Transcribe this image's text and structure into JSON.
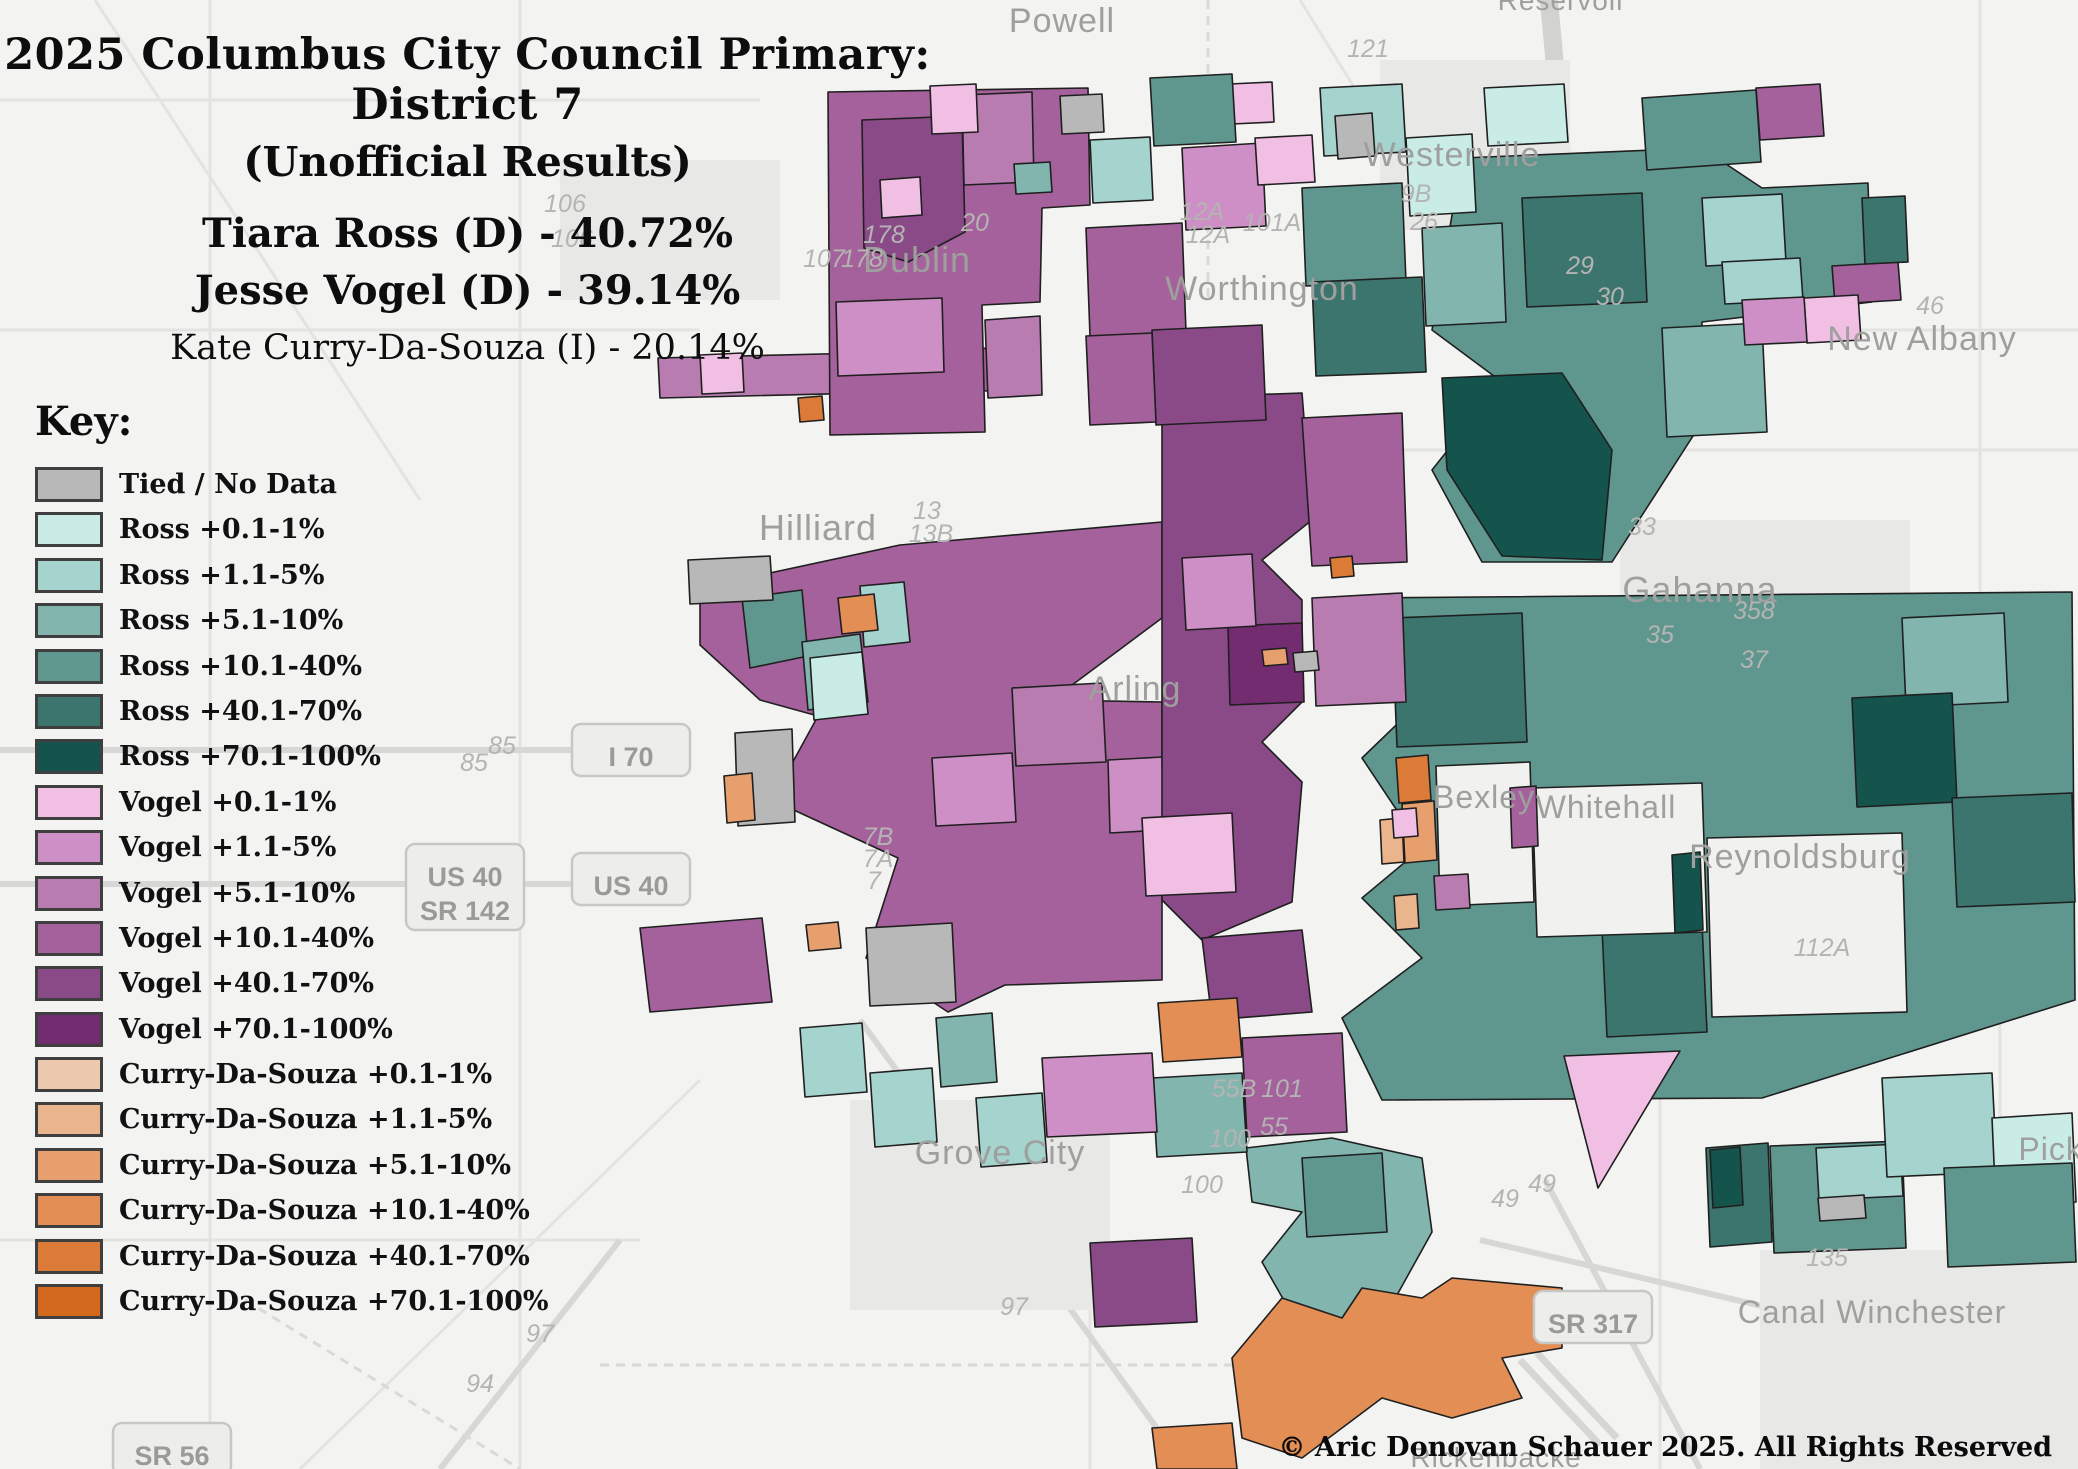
{
  "title": {
    "line1": "2025 Columbus City Council Primary: District 7",
    "line2": "(Unofficial Results)"
  },
  "results": [
    {
      "text": "Tiara Ross (D) - 40.72%",
      "emphasis": "bold"
    },
    {
      "text": "Jesse Vogel (D) - 39.14%",
      "emphasis": "bold"
    },
    {
      "text": "Kate Curry-Da-Souza (I) - 20.14%",
      "emphasis": "normal"
    }
  ],
  "key_header": "Key:",
  "copyright": "© Aric Donovan Schauer 2025. All Rights Reserved",
  "legend": {
    "items": [
      {
        "id": "tied",
        "label": "Tied / No Data",
        "color": "#b8b8b8"
      },
      {
        "id": "ross1",
        "label": "Ross +0.1-1%",
        "color": "#c9ece7"
      },
      {
        "id": "ross2",
        "label": "Ross +1.1-5%",
        "color": "#a5d3cd"
      },
      {
        "id": "ross3",
        "label": "Ross +5.1-10%",
        "color": "#81b5ae"
      },
      {
        "id": "ross4",
        "label": "Ross +10.1-40%",
        "color": "#5f978f"
      },
      {
        "id": "ross5",
        "label": "Ross +40.1-70%",
        "color": "#3c746e"
      },
      {
        "id": "ross6",
        "label": "Ross +70.1-100%",
        "color": "#15544c"
      },
      {
        "id": "vogel1",
        "label": "Vogel +0.1-1%",
        "color": "#f0bfe3"
      },
      {
        "id": "vogel2",
        "label": "Vogel +1.1-5%",
        "color": "#cd8fc5"
      },
      {
        "id": "vogel3",
        "label": "Vogel +5.1-10%",
        "color": "#b97cb1"
      },
      {
        "id": "vogel4",
        "label": "Vogel +10.1-40%",
        "color": "#a4619c"
      },
      {
        "id": "vogel5",
        "label": "Vogel +40.1-70%",
        "color": "#8a4a87"
      },
      {
        "id": "vogel6",
        "label": "Vogel +70.1-100%",
        "color": "#722c6f"
      },
      {
        "id": "curry1",
        "label": "Curry-Da-Souza +0.1-1%",
        "color": "#ecc8ac"
      },
      {
        "id": "curry2",
        "label": "Curry-Da-Souza +1.1-5%",
        "color": "#eab48c"
      },
      {
        "id": "curry3",
        "label": "Curry-Da-Souza +5.1-10%",
        "color": "#e7a06d"
      },
      {
        "id": "curry4",
        "label": "Curry-Da-Souza +10.1-40%",
        "color": "#e28e55"
      },
      {
        "id": "curry5",
        "label": "Curry-Da-Souza +40.1-70%",
        "color": "#dc7a38"
      },
      {
        "id": "curry6",
        "label": "Curry-Da-Souza +70.1-100%",
        "color": "#d2691d"
      }
    ]
  },
  "map": {
    "enclave_color": "#f1f1ef",
    "city_labels": [
      {
        "text": "Powell",
        "x": 1062,
        "y": 32,
        "size": 34
      },
      {
        "text": "Reservoir",
        "x": 1562,
        "y": 10,
        "size": 28
      },
      {
        "text": "Westerville",
        "x": 1452,
        "y": 166,
        "size": 34
      },
      {
        "text": "Dublin",
        "x": 917,
        "y": 272,
        "size": 36
      },
      {
        "text": "Worthington",
        "x": 1262,
        "y": 300,
        "size": 34
      },
      {
        "text": "New Albany",
        "x": 1922,
        "y": 350,
        "size": 34
      },
      {
        "text": "Hilliard",
        "x": 818,
        "y": 540,
        "size": 36
      },
      {
        "text": "Gahanna",
        "x": 1700,
        "y": 602,
        "size": 36
      },
      {
        "text": "Arling",
        "x": 1135,
        "y": 700,
        "size": 34
      },
      {
        "text": "Bexley",
        "x": 1484,
        "y": 808,
        "size": 32
      },
      {
        "text": "Whitehall",
        "x": 1606,
        "y": 818,
        "size": 32
      },
      {
        "text": "Reynoldsburg",
        "x": 1800,
        "y": 868,
        "size": 34
      },
      {
        "text": "Grove City",
        "x": 1000,
        "y": 1164,
        "size": 34
      },
      {
        "text": "Canal Winchester",
        "x": 1872,
        "y": 1323,
        "size": 32
      },
      {
        "text": "Picke",
        "x": 2060,
        "y": 1160,
        "size": 32
      },
      {
        "text": "Rickenbacke",
        "x": 1496,
        "y": 1467,
        "size": 28
      }
    ],
    "route_labels": [
      {
        "text": "121",
        "x": 1368,
        "y": 57
      },
      {
        "text": "106",
        "x": 565,
        "y": 212
      },
      {
        "text": "106",
        "x": 572,
        "y": 247
      },
      {
        "text": "178",
        "x": 884,
        "y": 243
      },
      {
        "text": "107",
        "x": 824,
        "y": 267
      },
      {
        "text": "178",
        "x": 862,
        "y": 267
      },
      {
        "text": "20",
        "x": 975,
        "y": 231
      },
      {
        "text": "12A",
        "x": 1202,
        "y": 220
      },
      {
        "text": "12A",
        "x": 1208,
        "y": 243
      },
      {
        "text": "101A",
        "x": 1272,
        "y": 231
      },
      {
        "text": "9B",
        "x": 1416,
        "y": 202
      },
      {
        "text": "26",
        "x": 1424,
        "y": 230
      },
      {
        "text": "29",
        "x": 1580,
        "y": 274
      },
      {
        "text": "30",
        "x": 1610,
        "y": 305
      },
      {
        "text": "46",
        "x": 1930,
        "y": 314
      },
      {
        "text": "33",
        "x": 1642,
        "y": 535
      },
      {
        "text": "358",
        "x": 1754,
        "y": 619
      },
      {
        "text": "35",
        "x": 1660,
        "y": 643
      },
      {
        "text": "37",
        "x": 1754,
        "y": 668
      },
      {
        "text": "13",
        "x": 927,
        "y": 519
      },
      {
        "text": "13B",
        "x": 931,
        "y": 542
      },
      {
        "text": "85",
        "x": 502,
        "y": 754
      },
      {
        "text": "85",
        "x": 474,
        "y": 771
      },
      {
        "text": "7B",
        "x": 878,
        "y": 845
      },
      {
        "text": "7A",
        "x": 878,
        "y": 867
      },
      {
        "text": "7",
        "x": 874,
        "y": 889
      },
      {
        "text": "112A",
        "x": 1822,
        "y": 956
      },
      {
        "text": "55B",
        "x": 1234,
        "y": 1097
      },
      {
        "text": "101",
        "x": 1282,
        "y": 1097
      },
      {
        "text": "55",
        "x": 1274,
        "y": 1135
      },
      {
        "text": "100",
        "x": 1230,
        "y": 1147
      },
      {
        "text": "100",
        "x": 1202,
        "y": 1193
      },
      {
        "text": "49",
        "x": 1542,
        "y": 1192
      },
      {
        "text": "49",
        "x": 1505,
        "y": 1207
      },
      {
        "text": "135",
        "x": 1827,
        "y": 1266
      },
      {
        "text": "97",
        "x": 1014,
        "y": 1315
      },
      {
        "text": "97",
        "x": 540,
        "y": 1342
      },
      {
        "text": "94",
        "x": 480,
        "y": 1392
      }
    ],
    "shields": [
      {
        "lines": [
          "I 70"
        ],
        "x": 631,
        "y": 750
      },
      {
        "lines": [
          "US 40"
        ],
        "x": 631,
        "y": 879
      },
      {
        "lines": [
          "US 40",
          "SR 142"
        ],
        "x": 465,
        "y": 887
      },
      {
        "lines": [
          "SR 317"
        ],
        "x": 1593,
        "y": 1317
      },
      {
        "lines": [
          "SR 56"
        ],
        "x": 172,
        "y": 1449
      }
    ],
    "regions": [
      {
        "c": "vogel3",
        "p": "658,358 905,352 907,392 660,398"
      },
      {
        "c": "ross2",
        "p": "907,352 948,350 950,390 909,392"
      },
      {
        "c": "vogel4",
        "p": "950,350 1012,347 1014,390 952,392"
      },
      {
        "c": "vogel1",
        "p": "700,355 742,353 744,392 702,394"
      },
      {
        "c": "vogel4",
        "p": "828,92 1088,88 1090,205 1042,208 1040,302 982,305 985,432 830,435"
      },
      {
        "c": "vogel5",
        "p": "862,120 962,116 965,232 908,262 864,248"
      },
      {
        "c": "vogel3",
        "p": "962,95 1032,92 1034,182 964,185"
      },
      {
        "c": "vogel2",
        "p": "836,302 942,298 944,372 838,376"
      },
      {
        "c": "vogel1",
        "p": "930,86 976,84 978,132 932,134"
      },
      {
        "c": "ross3",
        "p": "1014,164 1050,162 1052,192 1016,194"
      },
      {
        "c": "tied",
        "p": "1060,96 1102,94 1104,132 1062,134"
      },
      {
        "c": "curry5",
        "p": "798,398 822,396 824,420 800,422"
      },
      {
        "c": "vogel3",
        "p": "985,320 1040,316 1042,395 988,398"
      },
      {
        "c": "vogel1",
        "p": "880,180 920,177 922,215 882,218"
      },
      {
        "c": "vogel4",
        "p": "700,588 900,545 1162,522 1162,618 1052,700 1162,702 1162,980 1005,985 948,1012 866,958 898,858 772,800 818,716 760,700 700,645"
      },
      {
        "c": "ross4",
        "p": "742,598 802,590 808,656 750,668"
      },
      {
        "c": "ross3",
        "p": "802,642 860,634 868,702 808,710"
      },
      {
        "c": "ross2",
        "p": "860,586 904,582 910,642 864,647"
      },
      {
        "c": "ross1",
        "p": "810,658 862,652 868,714 814,720"
      },
      {
        "c": "curry4",
        "p": "838,598 874,594 878,630 842,634"
      },
      {
        "c": "tied",
        "p": "688,560 770,556 773,600 690,604"
      },
      {
        "c": "tied",
        "p": "735,733 792,729 795,822 738,826"
      },
      {
        "c": "vogel3",
        "p": "1012,688 1102,683 1106,762 1016,766"
      },
      {
        "c": "vogel2",
        "p": "932,758 1012,753 1016,822 936,826"
      },
      {
        "c": "tied",
        "p": "866,928 952,923 956,1002 870,1006"
      },
      {
        "c": "vogel4",
        "p": "640,928 762,918 772,1002 650,1012"
      },
      {
        "c": "vogel2",
        "p": "1108,760 1162,757 1164,830 1110,833"
      },
      {
        "c": "curry3",
        "p": "724,776 752,773 755,820 727,823"
      },
      {
        "c": "curry3",
        "p": "806,925 838,922 841,948 809,951"
      },
      {
        "c": "ross4",
        "p": "1462,158 1702,148 1762,188 1868,183 1872,302 1702,322 1702,422 1612,562 1482,562 1432,470 1502,382 1432,330"
      },
      {
        "c": "ross5",
        "p": "1522,198 1642,193 1647,302 1527,307"
      },
      {
        "c": "ross6",
        "p": "1442,378 1562,373 1612,450 1602,560 1502,556 1447,470"
      },
      {
        "c": "ross3",
        "p": "1662,328 1762,323 1767,432 1667,437"
      },
      {
        "c": "ross2",
        "p": "1702,198 1782,194 1786,262 1706,266"
      },
      {
        "c": "vogel4",
        "p": "1756,88 1820,84 1824,136 1760,140"
      },
      {
        "c": "ross4",
        "p": "1642,98 1756,90 1761,162 1647,170"
      },
      {
        "c": "ross2",
        "p": "1722,262 1800,258 1803,300 1725,304"
      },
      {
        "c": "vogel4",
        "p": "1832,266 1898,262 1901,300 1835,304"
      },
      {
        "c": "vogel1",
        "p": "1804,298 1858,295 1861,340 1807,343"
      },
      {
        "c": "vogel2",
        "p": "1742,300 1804,297 1807,342 1745,345"
      },
      {
        "c": "ross5",
        "p": "1862,198 1905,196 1908,262 1865,264"
      },
      {
        "c": "ross1",
        "p": "1484,88 1564,84 1568,142 1488,146"
      },
      {
        "c": "ross4",
        "p": "1362,598 2072,592 2075,1000 1762,1098 1382,1100 1342,1018 1422,958 1362,898 1422,848 1362,758 1422,700"
      },
      {
        "c": "ross5",
        "p": "1392,618 1522,613 1527,742 1397,747"
      },
      {
        "c": "ross3",
        "p": "1902,618 2004,613 2008,702 1906,707"
      },
      {
        "c": "ross6",
        "p": "1852,698 1952,693 1957,802 1857,807"
      },
      {
        "c": "ross5",
        "p": "1602,928 1702,923 1707,1032 1607,1037"
      },
      {
        "c": "ross5",
        "p": "1952,798 2072,793 2075,902 1957,907"
      },
      {
        "c": "nodist",
        "p": "1436,766 1530,762 1534,902 1440,906"
      },
      {
        "c": "nodist",
        "p": "1532,788 1702,783 1707,932 1537,937"
      },
      {
        "c": "nodist",
        "p": "1707,838 1902,833 1907,1012 1712,1017"
      },
      {
        "c": "ross6",
        "p": "1672,855 1700,852 1703,930 1675,933"
      },
      {
        "c": "curry5",
        "p": "1396,758 1428,755 1431,800 1399,803"
      },
      {
        "c": "curry3",
        "p": "1402,804 1434,801 1437,860 1405,863"
      },
      {
        "c": "curry2",
        "p": "1380,820 1402,818 1404,862 1382,864"
      },
      {
        "c": "vogel1",
        "p": "1392,810 1416,808 1418,836 1394,838"
      },
      {
        "c": "vogel4",
        "p": "1510,788 1536,786 1538,846 1512,848"
      },
      {
        "c": "vogel3",
        "p": "1434,876 1468,874 1470,908 1436,910"
      },
      {
        "c": "curry2",
        "p": "1394,896 1417,894 1419,928 1396,930"
      },
      {
        "c": "vogel5",
        "p": "1162,398 1302,393 1312,520 1262,560 1302,600 1302,702 1262,742 1302,782 1292,902 1202,940 1162,900"
      },
      {
        "c": "vogel4",
        "p": "1302,418 1402,413 1407,562 1312,566"
      },
      {
        "c": "vogel6",
        "p": "1228,626 1302,623 1304,702 1230,705"
      },
      {
        "c": "vogel3",
        "p": "1312,598 1402,593 1406,702 1316,706"
      },
      {
        "c": "vogel2",
        "p": "1182,558 1252,554 1256,626 1186,630"
      },
      {
        "c": "vogel1",
        "p": "1142,818 1232,813 1236,892 1146,896"
      },
      {
        "c": "vogel5",
        "p": "1202,938 1302,930 1312,1012 1212,1020"
      },
      {
        "c": "curry3",
        "p": "1262,650 1286,648 1288,664 1264,666"
      },
      {
        "c": "tied",
        "p": "1293,653 1317,651 1319,670 1295,672"
      },
      {
        "c": "curry5",
        "p": "1330,558 1352,556 1354,576 1332,578"
      },
      {
        "c": "vogel4",
        "p": "1086,228 1182,223 1186,332 1090,336"
      },
      {
        "c": "vogel5",
        "p": "1152,330 1262,325 1266,420 1156,425"
      },
      {
        "c": "vogel2",
        "p": "1182,148 1262,143 1266,226 1186,230"
      },
      {
        "c": "vogel1",
        "p": "1255,138 1312,135 1315,182 1258,185"
      },
      {
        "c": "ross2",
        "p": "1320,88 1402,84 1406,152 1324,156"
      },
      {
        "c": "ross1",
        "p": "1406,138 1472,134 1476,212 1410,216"
      },
      {
        "c": "ross4",
        "p": "1302,188 1402,183 1406,282 1306,286"
      },
      {
        "c": "ross5",
        "p": "1312,282 1422,277 1426,372 1316,376"
      },
      {
        "c": "ross3",
        "p": "1422,228 1502,223 1506,322 1426,326"
      },
      {
        "c": "tied",
        "p": "1335,116 1372,113 1375,156 1338,159"
      },
      {
        "c": "vogel4",
        "p": "1086,336 1152,333 1156,422 1090,425"
      },
      {
        "c": "vogel1",
        "p": "1230,84 1272,82 1274,122 1232,124"
      },
      {
        "c": "ross4",
        "p": "1150,78 1232,74 1236,142 1154,146"
      },
      {
        "c": "ross2",
        "p": "1090,140 1150,137 1153,200 1093,203"
      },
      {
        "c": "ross5",
        "p": "1706,1148 1768,1143 1772,1242 1710,1247"
      },
      {
        "c": "ross4",
        "p": "1770,1146 1902,1141 1906,1248 1774,1253"
      },
      {
        "c": "ross2",
        "p": "1816,1148 1900,1144 1903,1196 1819,1200"
      },
      {
        "c": "tied",
        "p": "1818,1198 1864,1195 1866,1218 1820,1221"
      },
      {
        "c": "ross6",
        "p": "1710,1150 1740,1147 1743,1205 1713,1208"
      },
      {
        "c": "ross2",
        "p": "1882,1078 1992,1073 1997,1172 1887,1177"
      },
      {
        "c": "ross1",
        "p": "1992,1118 2072,1113 2076,1202 1996,1207"
      },
      {
        "c": "ross4",
        "p": "1944,1168 2072,1163 2076,1262 1948,1267"
      },
      {
        "c": "vogel1",
        "p": "1564,1056 1680,1051 1598,1188"
      },
      {
        "c": "ross3",
        "p": "1246,1148 1332,1138 1422,1158 1432,1232 1382,1322 1302,1332 1262,1262 1302,1212 1252,1202"
      },
      {
        "c": "ross4",
        "p": "1302,1158 1382,1153 1387,1232 1307,1237"
      },
      {
        "c": "vogel4",
        "p": "1242,1038 1342,1033 1347,1132 1247,1137"
      },
      {
        "c": "ross3",
        "p": "1152,1078 1242,1073 1247,1152 1157,1157"
      },
      {
        "c": "curry4",
        "p": "1158,1003 1237,998 1242,1057 1163,1062"
      },
      {
        "c": "vogel2",
        "p": "1042,1058 1152,1053 1157,1132 1047,1137"
      },
      {
        "c": "vogel5",
        "p": "1090,1243 1192,1238 1197,1322 1095,1327"
      },
      {
        "c": "ross2",
        "p": "976,1098 1042,1093 1047,1162 981,1167"
      },
      {
        "c": "ross2",
        "p": "800,1028 862,1023 867,1092 805,1097"
      },
      {
        "c": "ross2",
        "p": "870,1073 932,1068 937,1142 875,1147"
      },
      {
        "c": "ross3",
        "p": "936,1018 992,1013 997,1082 941,1087"
      },
      {
        "c": "curry4",
        "p": "1232,1358 1282,1298 1342,1318 1362,1288 1422,1298 1452,1278 1562,1288 1562,1348 1502,1358 1522,1398 1452,1418 1382,1398 1302,1458 1242,1438"
      },
      {
        "c": "curry4",
        "p": "1152,1428 1232,1423 1237,1469 1157,1469"
      }
    ]
  }
}
